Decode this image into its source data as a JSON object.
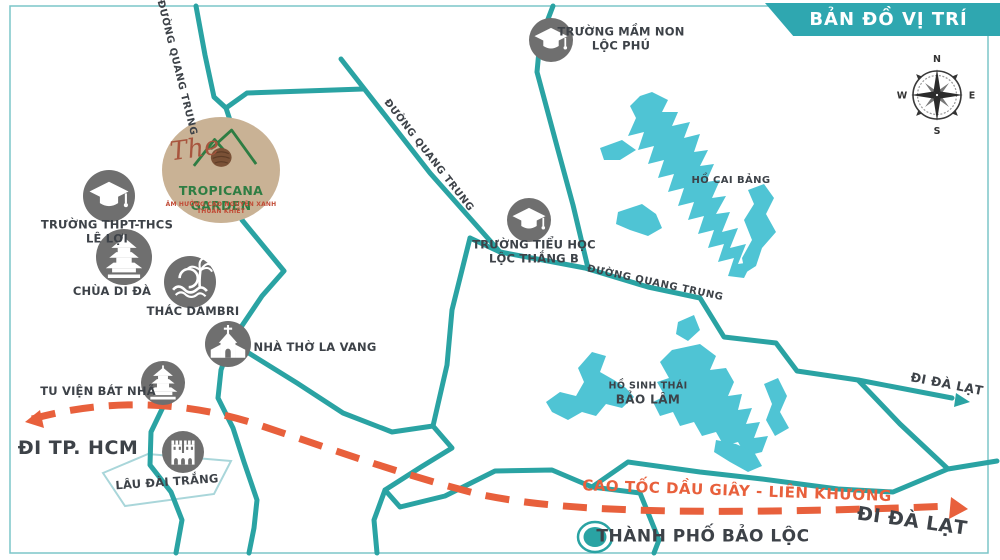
{
  "banner": {
    "title": "BẢN ĐỒ VỊ TRÍ"
  },
  "compass": {
    "n": "N",
    "e": "E",
    "s": "S",
    "w": "W"
  },
  "logo": {
    "script_word": "The",
    "name": "TROPICANA GARDEN",
    "tagline": "ÂM HƯỞNG CAO NGUYÊN XANH THUẦN KHIẾT"
  },
  "landmarks": {
    "mam_non": {
      "line1": "TRƯỜNG MẦM NON",
      "line2": "LỘC PHÚ"
    },
    "le_loi": {
      "line1": "TRƯỜNG THPT-THCS",
      "line2": "LÊ LỢI"
    },
    "chua_di_da": {
      "line1": "CHÙA DI ĐÀ"
    },
    "thac_dambri": {
      "line1": "THÁC DAMBRI"
    },
    "nha_tho_la_vang": {
      "line1": "NHÀ THỜ LA VANG"
    },
    "tu_vien_bat_nha": {
      "line1": "TU VIỆN BÁT NHÃ"
    },
    "lau_dai_trang": {
      "line1": "LÂU ĐÀI TRẮNG"
    },
    "tieu_hoc_loc_thang": {
      "line1": "TRƯỜNG TIỂU HỌC",
      "line2": "LỘC THẮNG B"
    }
  },
  "roads": {
    "quang_trung_1": "ĐƯỜNG QUANG TRUNG",
    "quang_trung_2": "ĐƯỜNG QUANG TRUNG",
    "quang_trung_3": "ĐƯỜNG QUANG TRUNG",
    "highway": "CAO TỐC DẦU GIÂY - LIÊN KHƯƠNG"
  },
  "directions": {
    "hcm": "ĐI TP. HCM",
    "da_lat_north": "ĐI ĐÀ LẠT",
    "da_lat_highway": "ĐI ĐÀ LẠT"
  },
  "lakes": {
    "cai_bang": {
      "line1": "HỒ CAI BẢNG"
    },
    "bao_lam": {
      "line1": "HỒ SINH THÁI",
      "line2": "BẢO LÂM"
    }
  },
  "city": {
    "name": "THÀNH PHỐ BẢO LỘC"
  },
  "colors": {
    "road_teal": "#2aa3a3",
    "lake_blue": "#4fc4d4",
    "highway_orange": "#e8603c",
    "icon_gray": "#6f6f6f",
    "label_dark": "#3d4248",
    "banner_teal": "#2fa7b0",
    "logo_beige": "#c9b295",
    "logo_green": "#2e7d43",
    "logo_red": "#c14b36"
  }
}
